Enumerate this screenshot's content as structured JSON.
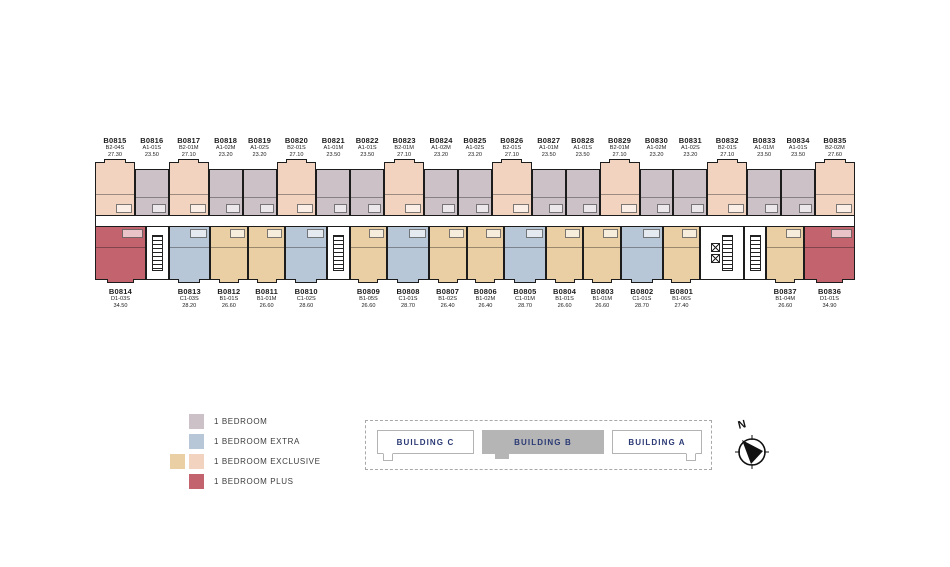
{
  "floor": {
    "building_title": "BUILDING B"
  },
  "colors": {
    "bedroom": "#cbc1c7",
    "extra": "#b8c7d8",
    "exclusive_tan": "#eacfa5",
    "exclusive_peach": "#f2d3c0",
    "plus": "#c2636e",
    "wall": "#1c1c1c",
    "selector_fill": "#b5b5b5",
    "selector_text": "#2b3a75"
  },
  "floor_plan": {
    "top_row": [
      {
        "unit": "B0815",
        "type": "B2-04S",
        "area": "27.30",
        "cat": "exclusive_peach"
      },
      {
        "unit": "B0816",
        "type": "A1-01S",
        "area": "23.50",
        "cat": "bedroom"
      },
      {
        "unit": "B0817",
        "type": "B2-01M",
        "area": "27.10",
        "cat": "exclusive_peach"
      },
      {
        "unit": "B0818",
        "type": "A1-02M",
        "area": "23.20",
        "cat": "bedroom"
      },
      {
        "unit": "B0819",
        "type": "A1-02S",
        "area": "23.20",
        "cat": "bedroom"
      },
      {
        "unit": "B0820",
        "type": "B2-01S",
        "area": "27.10",
        "cat": "exclusive_peach"
      },
      {
        "unit": "B0821",
        "type": "A1-01M",
        "area": "23.50",
        "cat": "bedroom"
      },
      {
        "unit": "B0822",
        "type": "A1-01S",
        "area": "23.50",
        "cat": "bedroom"
      },
      {
        "unit": "B0823",
        "type": "B2-01M",
        "area": "27.10",
        "cat": "exclusive_peach"
      },
      {
        "unit": "B0824",
        "type": "A1-02M",
        "area": "23.20",
        "cat": "bedroom"
      },
      {
        "unit": "B0825",
        "type": "A1-02S",
        "area": "23.20",
        "cat": "bedroom"
      },
      {
        "unit": "B0826",
        "type": "B2-01S",
        "area": "27.10",
        "cat": "exclusive_peach"
      },
      {
        "unit": "B0827",
        "type": "A1-01M",
        "area": "23.50",
        "cat": "bedroom"
      },
      {
        "unit": "B0828",
        "type": "A1-01S",
        "area": "23.50",
        "cat": "bedroom"
      },
      {
        "unit": "B0829",
        "type": "B2-01M",
        "area": "27.10",
        "cat": "exclusive_peach"
      },
      {
        "unit": "B0830",
        "type": "A1-02M",
        "area": "23.20",
        "cat": "bedroom"
      },
      {
        "unit": "B0831",
        "type": "A1-02S",
        "area": "23.20",
        "cat": "bedroom"
      },
      {
        "unit": "B0832",
        "type": "B2-01S",
        "area": "27.10",
        "cat": "exclusive_peach"
      },
      {
        "unit": "B0833",
        "type": "A1-01M",
        "area": "23.50",
        "cat": "bedroom"
      },
      {
        "unit": "B0834",
        "type": "A1-01S",
        "area": "23.50",
        "cat": "bedroom"
      },
      {
        "unit": "B0835",
        "type": "B2-02M",
        "area": "27.60",
        "cat": "exclusive_peach"
      }
    ],
    "bottom_row": [
      {
        "unit": "B0814",
        "type": "D1-03S",
        "area": "34.50",
        "cat": "plus"
      },
      {
        "core": "stair"
      },
      {
        "unit": "B0813",
        "type": "C1-03S",
        "area": "28.20",
        "cat": "extra"
      },
      {
        "unit": "B0812",
        "type": "B1-01S",
        "area": "26.60",
        "cat": "exclusive_tan"
      },
      {
        "unit": "B0811",
        "type": "B1-01M",
        "area": "26.60",
        "cat": "exclusive_tan"
      },
      {
        "unit": "B0810",
        "type": "C1-02S",
        "area": "28.60",
        "cat": "extra"
      },
      {
        "core": "stair"
      },
      {
        "unit": "B0809",
        "type": "B1-05S",
        "area": "26.60",
        "cat": "exclusive_tan"
      },
      {
        "unit": "B0808",
        "type": "C1-01S",
        "area": "28.70",
        "cat": "extra"
      },
      {
        "unit": "B0807",
        "type": "B1-02S",
        "area": "26.40",
        "cat": "exclusive_tan"
      },
      {
        "unit": "B0806",
        "type": "B1-02M",
        "area": "26.40",
        "cat": "exclusive_tan"
      },
      {
        "unit": "B0805",
        "type": "C1-01M",
        "area": "28.70",
        "cat": "extra"
      },
      {
        "unit": "B0804",
        "type": "B1-01S",
        "area": "26.60",
        "cat": "exclusive_tan"
      },
      {
        "unit": "B0803",
        "type": "B1-01M",
        "area": "26.60",
        "cat": "exclusive_tan"
      },
      {
        "unit": "B0802",
        "type": "C1-01S",
        "area": "28.70",
        "cat": "extra"
      },
      {
        "unit": "B0801",
        "type": "B1-06S",
        "area": "27.40",
        "cat": "exclusive_tan"
      },
      {
        "core": "elevator"
      },
      {
        "core": "stair"
      },
      {
        "unit": "B0837",
        "type": "B1-04M",
        "area": "26.60",
        "cat": "exclusive_tan"
      },
      {
        "unit": "B0836",
        "type": "D1-01S",
        "area": "34.90",
        "cat": "plus"
      }
    ]
  },
  "legend": {
    "items": [
      {
        "label": "1 BEDROOM",
        "colors": [
          "#cbc1c7"
        ]
      },
      {
        "label": "1 BEDROOM EXTRA",
        "colors": [
          "#b8c7d8"
        ]
      },
      {
        "label": "1 BEDROOM EXCLUSIVE",
        "colors": [
          "#eacfa5",
          "#f2d3c0"
        ]
      },
      {
        "label": "1 BEDROOM PLUS",
        "colors": [
          "#c2636e"
        ]
      }
    ]
  },
  "building_selector": {
    "buildings": [
      {
        "label": "BUILDING C",
        "selected": false
      },
      {
        "label": "BUILDING B",
        "selected": true
      },
      {
        "label": "BUILDING A",
        "selected": false
      }
    ]
  },
  "compass": {
    "label": "N"
  }
}
